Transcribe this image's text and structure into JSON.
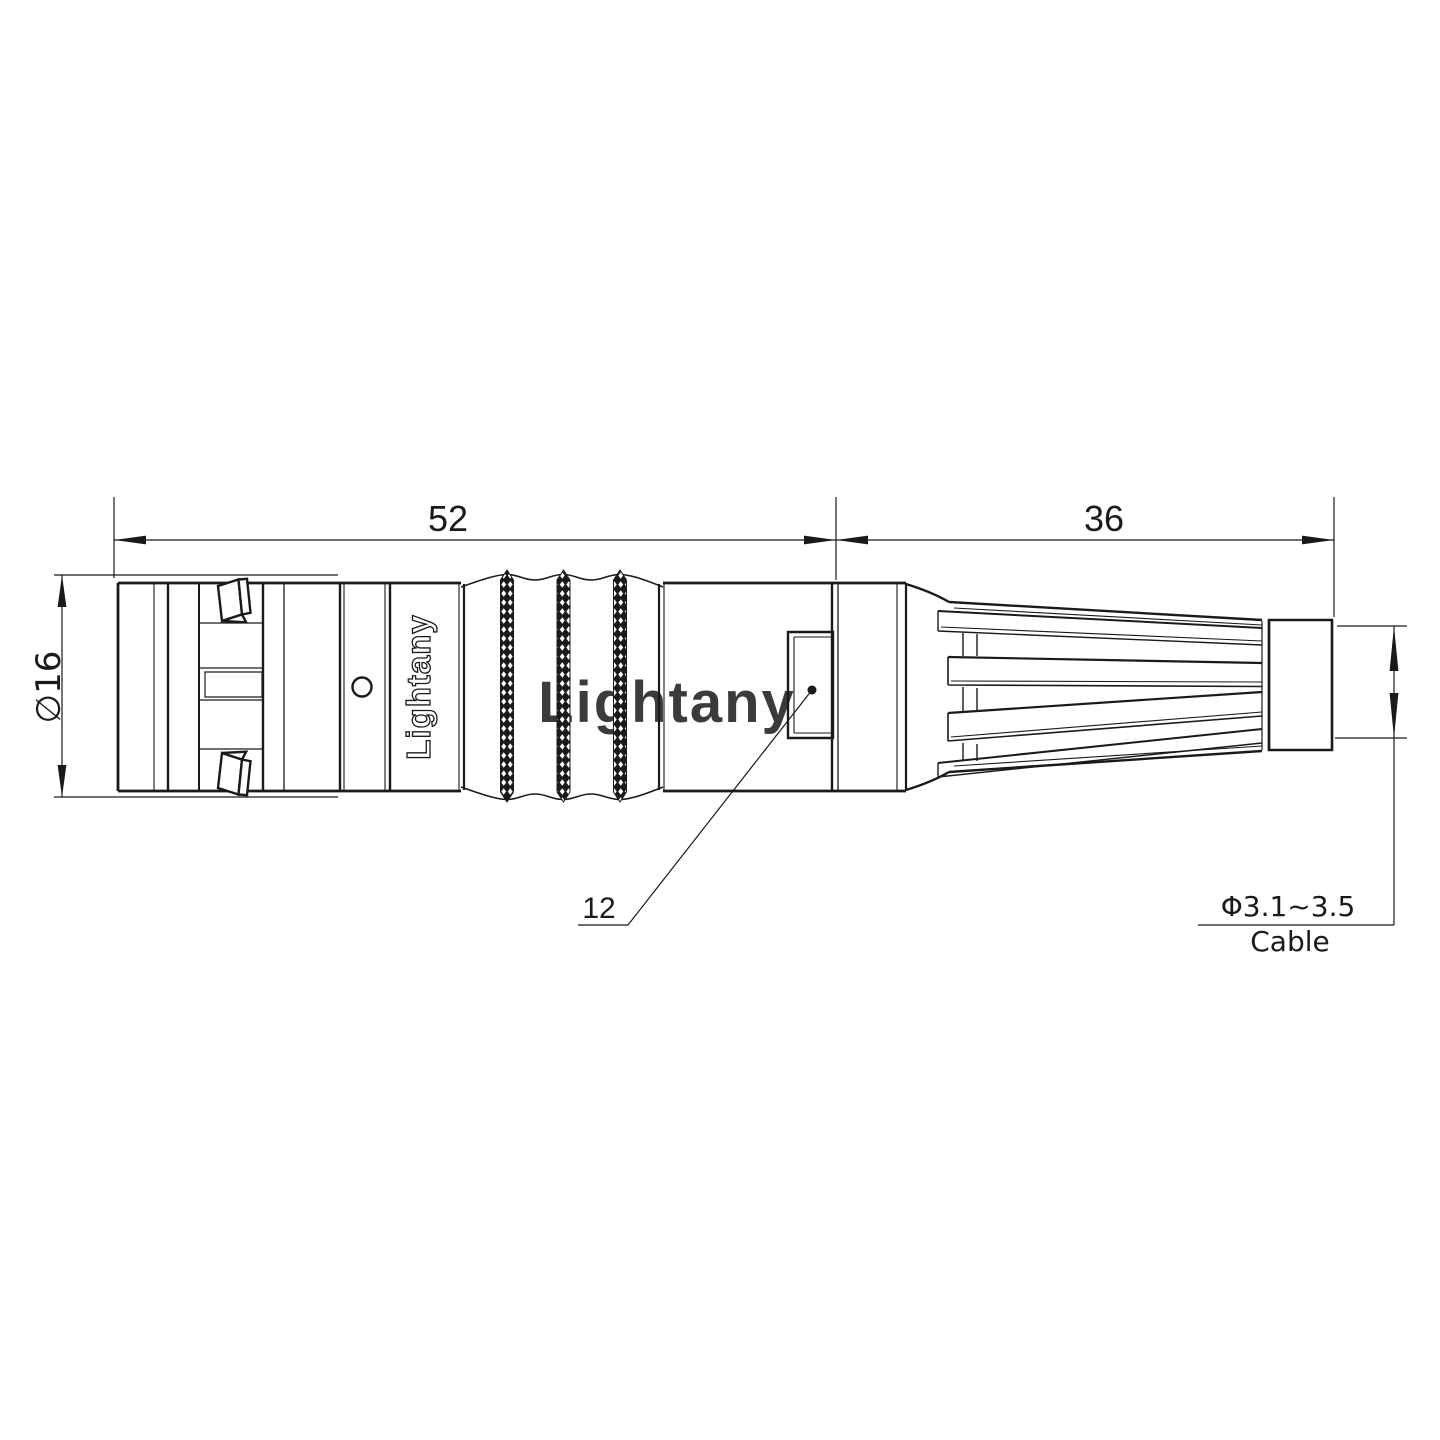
{
  "page": {
    "background": "#ffffff",
    "kind": "connector-technical-drawing"
  },
  "watermark": {
    "text": "Lightany",
    "color": "#f5c2c2"
  },
  "connector": {
    "brand_label": "Lightany"
  },
  "dims": {
    "body_length": "52",
    "boot_length": "36",
    "body_diameter": "∅16",
    "window_label": "12",
    "cable_diameter": "Φ3.1~3.5",
    "cable_label": "Cable"
  }
}
